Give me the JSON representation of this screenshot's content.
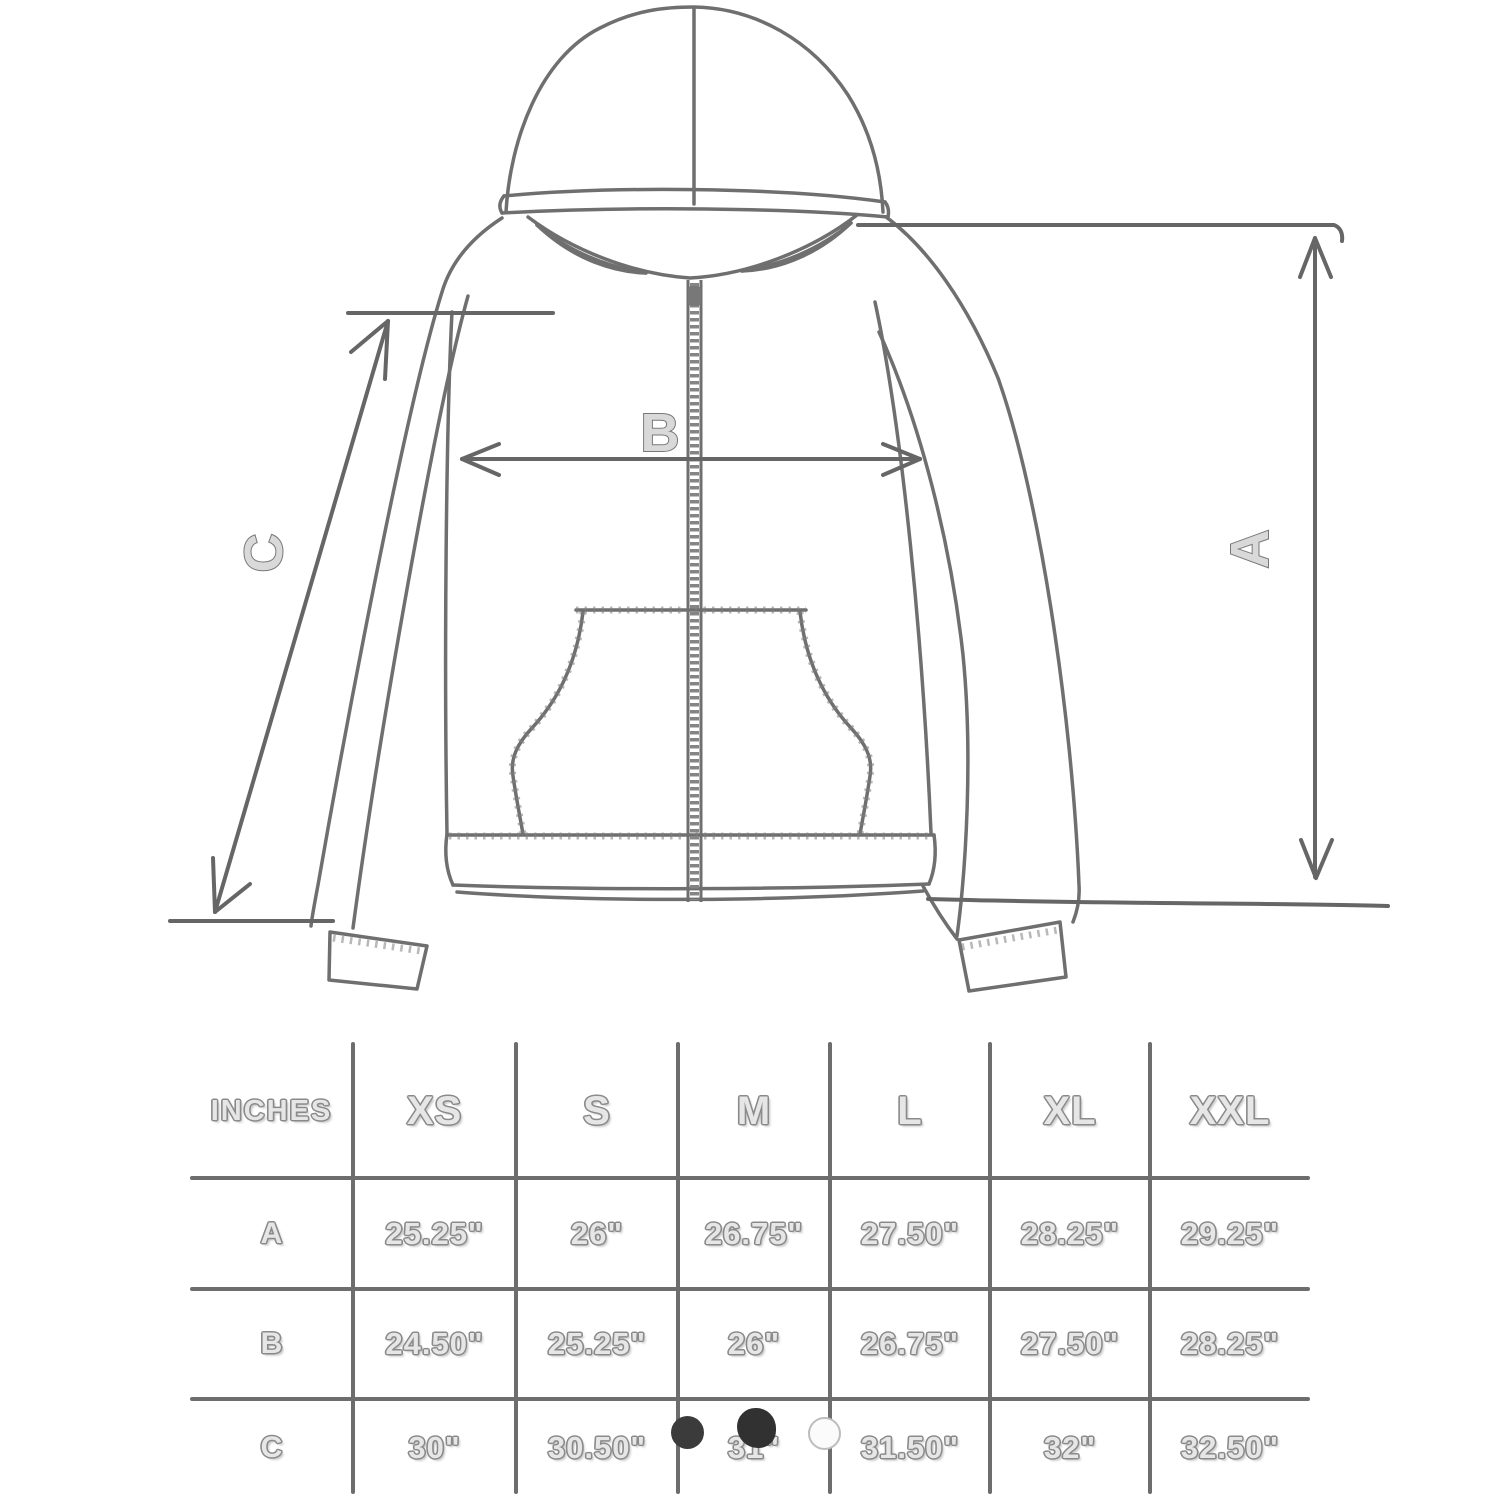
{
  "diagram": {
    "labels": {
      "length": "A",
      "chest_width": "B",
      "sleeve": "C"
    }
  },
  "table": {
    "unit_label": "INCHES",
    "size_columns": [
      "XS",
      "S",
      "M",
      "L",
      "XL",
      "XXL"
    ],
    "rows": [
      {
        "label": "A",
        "values": [
          "25.25\"",
          "26\"",
          "26.75\"",
          "27.50\"",
          "28.25\"",
          "29.25\""
        ]
      },
      {
        "label": "B",
        "values": [
          "24.50\"",
          "25.25\"",
          "26\"",
          "26.75\"",
          "27.50\"",
          "28.25\""
        ]
      },
      {
        "label": "C",
        "values": [
          "30\"",
          "30.50\"",
          "31\"",
          "31.50\"",
          "32\"",
          "32.50\""
        ]
      }
    ]
  },
  "colors": {
    "line": "#6d6d6d",
    "text_fill": "#e6e6e6",
    "text_outline": "#8a8a8a",
    "dark_dot": "#333333",
    "light_dot": "#fbfbfb"
  }
}
